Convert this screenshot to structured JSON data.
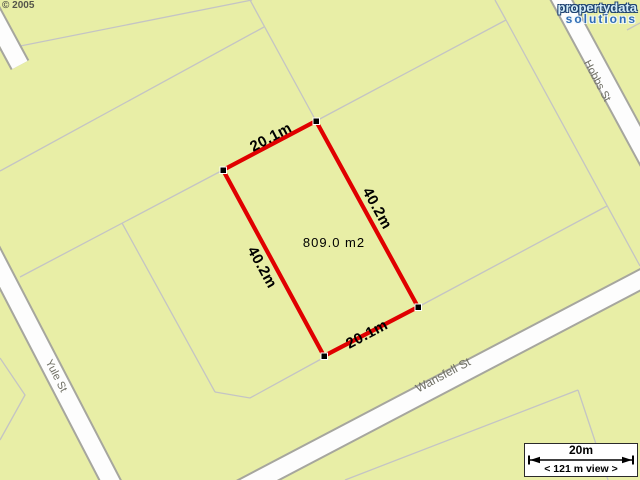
{
  "map": {
    "copyright": "© 2005",
    "logo": {
      "line1": "propertydata",
      "line2": "solutions"
    },
    "parcel": {
      "area_label": "809.0 m2",
      "dim_top": "20.1m",
      "dim_right": "40.2m",
      "dim_bottom": "20.1m",
      "dim_left": "40.2m"
    },
    "streets": {
      "left": "Yule St",
      "bottom": "Wansfell St",
      "top_right": "Hobbs St"
    },
    "scalebar": {
      "distance": "20m",
      "view_label": "< 121 m view >"
    },
    "colors": {
      "parcel_fill": "#e8eea6",
      "boundary_line": "#c4c4c4",
      "highlight_red": "#e00000",
      "road_fill": "#fdfdfd"
    }
  }
}
